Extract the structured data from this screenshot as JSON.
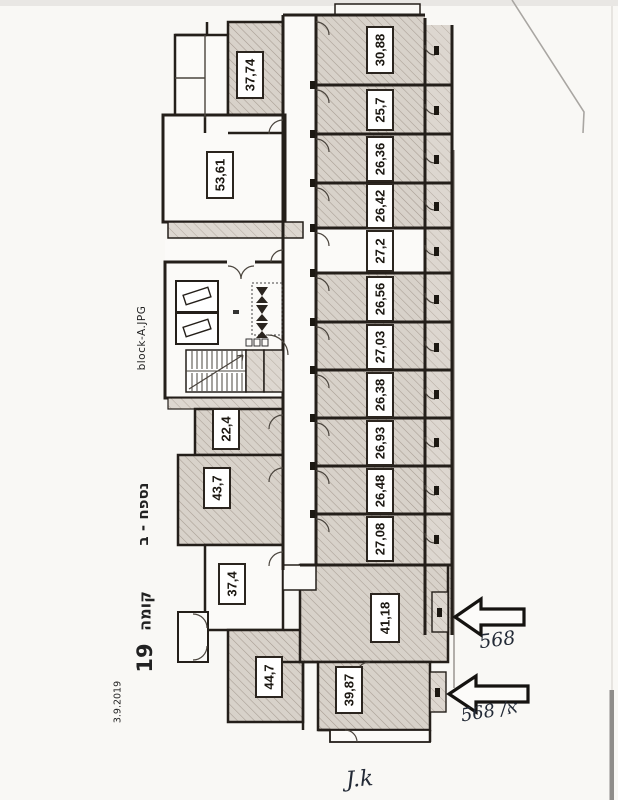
{
  "page": {
    "file_label": "block-A.JPG",
    "appendix_label": "נספח - ב",
    "floor_word": "קומה",
    "floor_number": "19",
    "date": "3.9.2019"
  },
  "plan": {
    "right_stack": [
      "30,88",
      "25,7",
      "26,36",
      "26,42",
      "27,2",
      "26,56",
      "27,03",
      "26,38",
      "26,93",
      "26,48",
      "27,08"
    ],
    "left_top": [
      "37,74",
      "53,61"
    ],
    "left_mid": [
      "22,4",
      "43,7",
      "37,4"
    ],
    "bottom": [
      "41,18",
      "39,87",
      "44,7"
    ]
  },
  "annotations": {
    "arrow1_note": "568",
    "arrow2_note": "א/ 568",
    "signature": "J.k"
  },
  "colors": {
    "wall": "#241f1a",
    "hatch_bg": "#d8d2ca",
    "hatch_line": "#a69c92",
    "paper": "#f9f8f5",
    "ink": "#232a36"
  }
}
